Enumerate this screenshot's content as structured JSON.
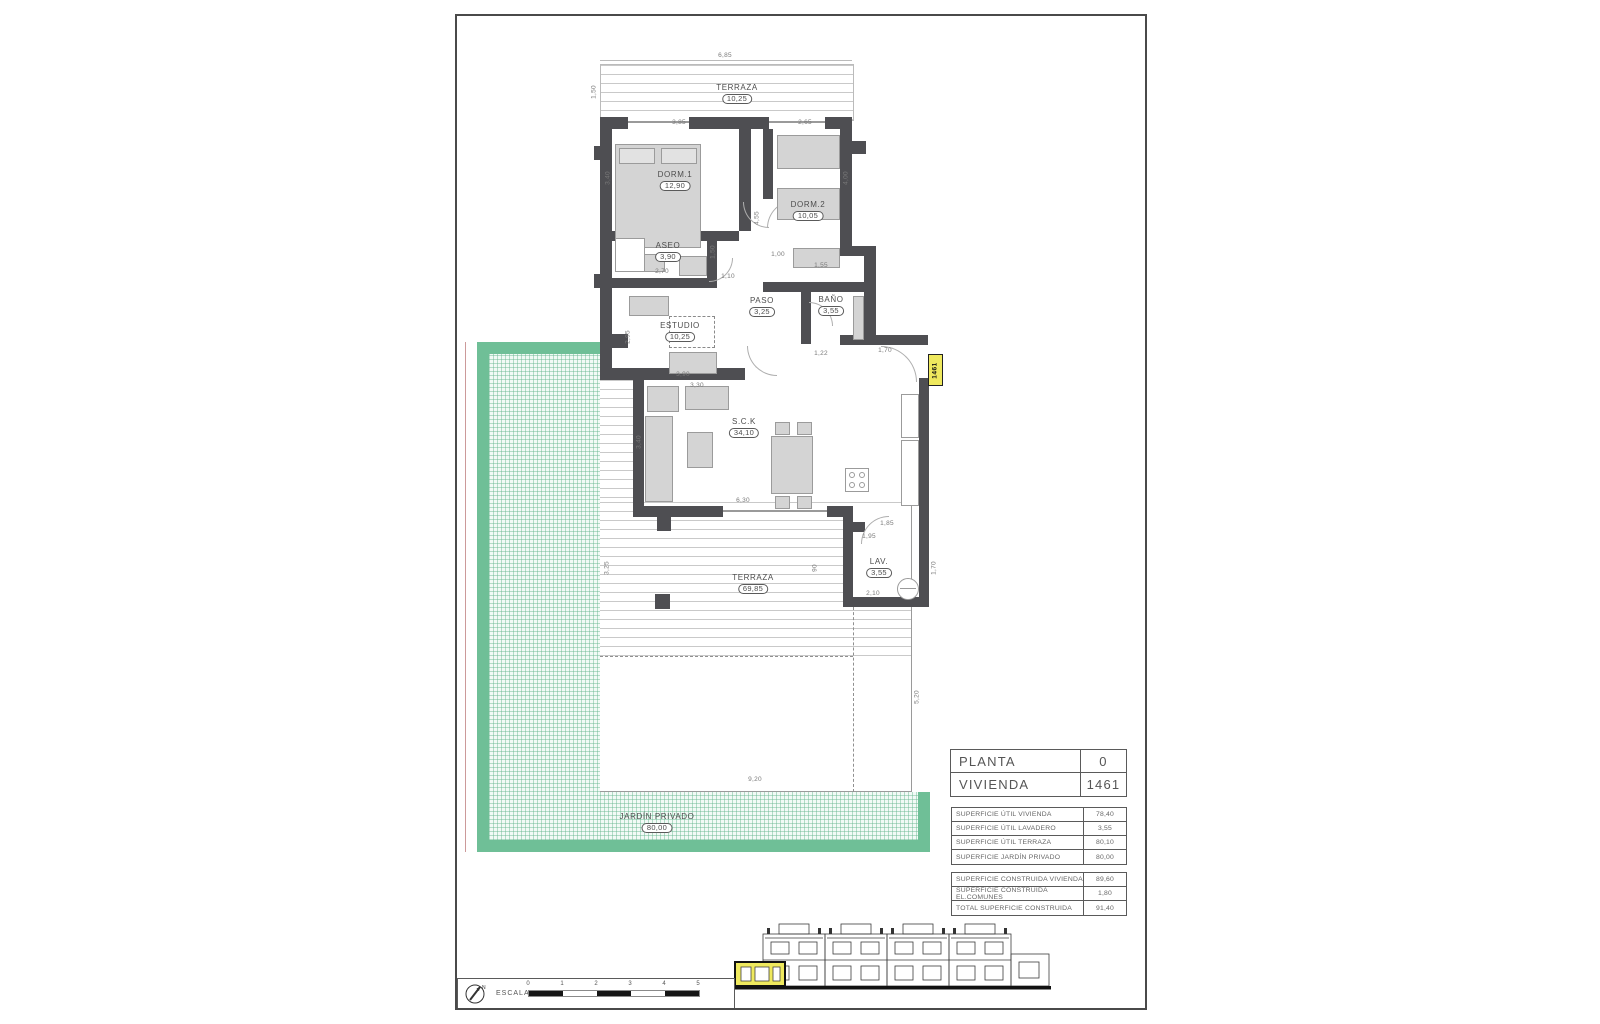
{
  "titleblock": {
    "planta_label": "PLANTA",
    "planta_value": "0",
    "vivienda_label": "VIVIENDA",
    "vivienda_value": "1461"
  },
  "areas_util": [
    {
      "label": "SUPERFICIE ÚTIL VIVIENDA",
      "value": "78,40"
    },
    {
      "label": "SUPERFICIE ÚTIL LAVADERO",
      "value": "3,55"
    },
    {
      "label": "SUPERFICIE ÚTIL TERRAZA",
      "value": "80,10"
    },
    {
      "label": "SUPERFICIE JARDÍN PRIVADO",
      "value": "80,00"
    }
  ],
  "areas_construida": [
    {
      "label": "SUPERFICIE CONSTRUIDA VIVIENDA",
      "value": "89,60"
    },
    {
      "label": "SUPERFICIE CONSTRUIDA EL.COMUNES",
      "value": "1,80"
    },
    {
      "label": "TOTAL SUPERFICIE CONSTRUIDA",
      "value": "91,40"
    }
  ],
  "rooms": {
    "terraza_sup": {
      "name": "TERRAZA",
      "area": "10,25"
    },
    "dorm1": {
      "name": "DORM.1",
      "area": "12,90"
    },
    "dorm2": {
      "name": "DORM.2",
      "area": "10,05"
    },
    "aseo": {
      "name": "ASEO",
      "area": "3,90"
    },
    "paso": {
      "name": "PASO",
      "area": "3,25"
    },
    "bano": {
      "name": "BAÑO",
      "area": "3,55"
    },
    "estudio": {
      "name": "ESTUDIO",
      "area": "10,25"
    },
    "sck": {
      "name": "S.C.K",
      "area": "34,10"
    },
    "lav": {
      "name": "LAV.",
      "area": "3,55"
    },
    "terraza_inf": {
      "name": "TERRAZA",
      "area": "69,85"
    },
    "jardin": {
      "name": "JARDÍN PRIVADO",
      "area": "80,00"
    }
  },
  "unit_tag": "1461",
  "scale_bar": {
    "label": "ESCALA :",
    "ticks": [
      "0",
      "1",
      "2",
      "3",
      "4",
      "5"
    ]
  },
  "compass": {
    "north_label": "N"
  },
  "dimensions": [
    "6,85",
    "1,50",
    "3,85",
    "2,65",
    "3,40",
    "4,00",
    "4,55",
    "2,70",
    "1,50",
    "1,10",
    "1,00",
    "1,55",
    "1,22",
    "2,95",
    "3,90",
    "3,30",
    "3,40",
    "6,30",
    "1,70",
    "1,85",
    "1,95",
    "2,10",
    "1,70",
    "90",
    "3,25",
    "5,20",
    "9,20"
  ],
  "colors": {
    "wall": "#4e4e52",
    "garden_band": "#6fbf97",
    "highlight_yellow": "#efe95e"
  }
}
